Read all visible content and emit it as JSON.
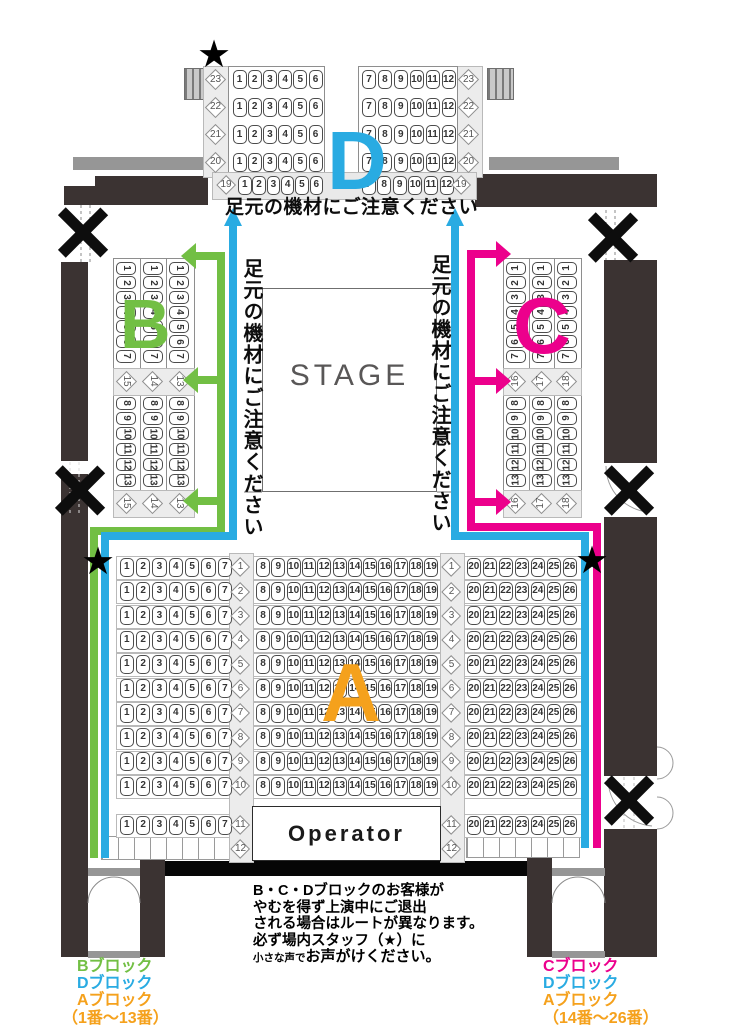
{
  "colors": {
    "green": "#72bf44",
    "cyan": "#29abe2",
    "magenta": "#ec008c",
    "orange": "#f5a11c",
    "wall": "#3b3332"
  },
  "stage_label": "STAGE",
  "operator_label": "Operator",
  "star_symbol": "★",
  "warnings": {
    "top": "足元の機材にご注意ください",
    "side_left": "足元の機材にご注意ください",
    "side_right": "足元の機材にご注意ください"
  },
  "blocks": {
    "A": {
      "letter": "A",
      "row_labels": [
        1,
        2,
        3,
        4,
        5,
        6,
        7,
        8,
        9,
        10,
        11,
        12
      ],
      "sections": [
        {
          "name": "left",
          "rows": 11,
          "seats": [
            1,
            2,
            3,
            4,
            5,
            6,
            7
          ]
        },
        {
          "name": "center",
          "rows": 10,
          "seats": [
            8,
            9,
            10,
            11,
            12,
            13,
            14,
            15,
            16,
            17,
            18,
            19
          ]
        },
        {
          "name": "right",
          "rows": 11,
          "seats": [
            20,
            21,
            22,
            23,
            24,
            25,
            26
          ]
        }
      ]
    },
    "B": {
      "letter": "B",
      "column_labels": [
        15,
        14,
        13
      ],
      "upper_seats": [
        1,
        2,
        3,
        4,
        5,
        6,
        7
      ],
      "lower_seats": [
        8,
        9,
        10,
        11,
        12,
        13
      ]
    },
    "C": {
      "letter": "C",
      "column_labels": [
        16,
        17,
        18
      ],
      "upper_seats": [
        1,
        2,
        3,
        4,
        5,
        6,
        7
      ],
      "lower_seats": [
        8,
        9,
        10,
        11,
        12,
        13
      ]
    },
    "D": {
      "letter": "D",
      "row_labels": [
        23,
        22,
        21,
        20,
        19
      ],
      "left_seats": [
        1,
        2,
        3,
        4,
        5,
        6
      ],
      "right_seats": [
        7,
        8,
        9,
        10,
        11,
        12
      ]
    }
  },
  "notice": {
    "lines": [
      "B・C・Dブロックのお客様が",
      "やむを得ず上演中にご退出",
      "される場合はルートが異なります。",
      "必ず場内スタッフ（★）に"
    ],
    "last_line_small": "小さな声で",
    "last_line_rest": "お声がけください。"
  },
  "legend_left": {
    "items": [
      {
        "label": "Bブロック",
        "color": "green"
      },
      {
        "label": "Dブロック",
        "color": "cyan"
      },
      {
        "label": "Aブロック",
        "color": "orange"
      },
      {
        "label": "（1番～13番）",
        "color": "orange"
      }
    ]
  },
  "legend_right": {
    "items": [
      {
        "label": "Cブロック",
        "color": "magenta"
      },
      {
        "label": "Dブロック",
        "color": "cyan"
      },
      {
        "label": "Aブロック",
        "color": "orange"
      },
      {
        "label": "（14番～26番）",
        "color": "orange"
      }
    ]
  }
}
